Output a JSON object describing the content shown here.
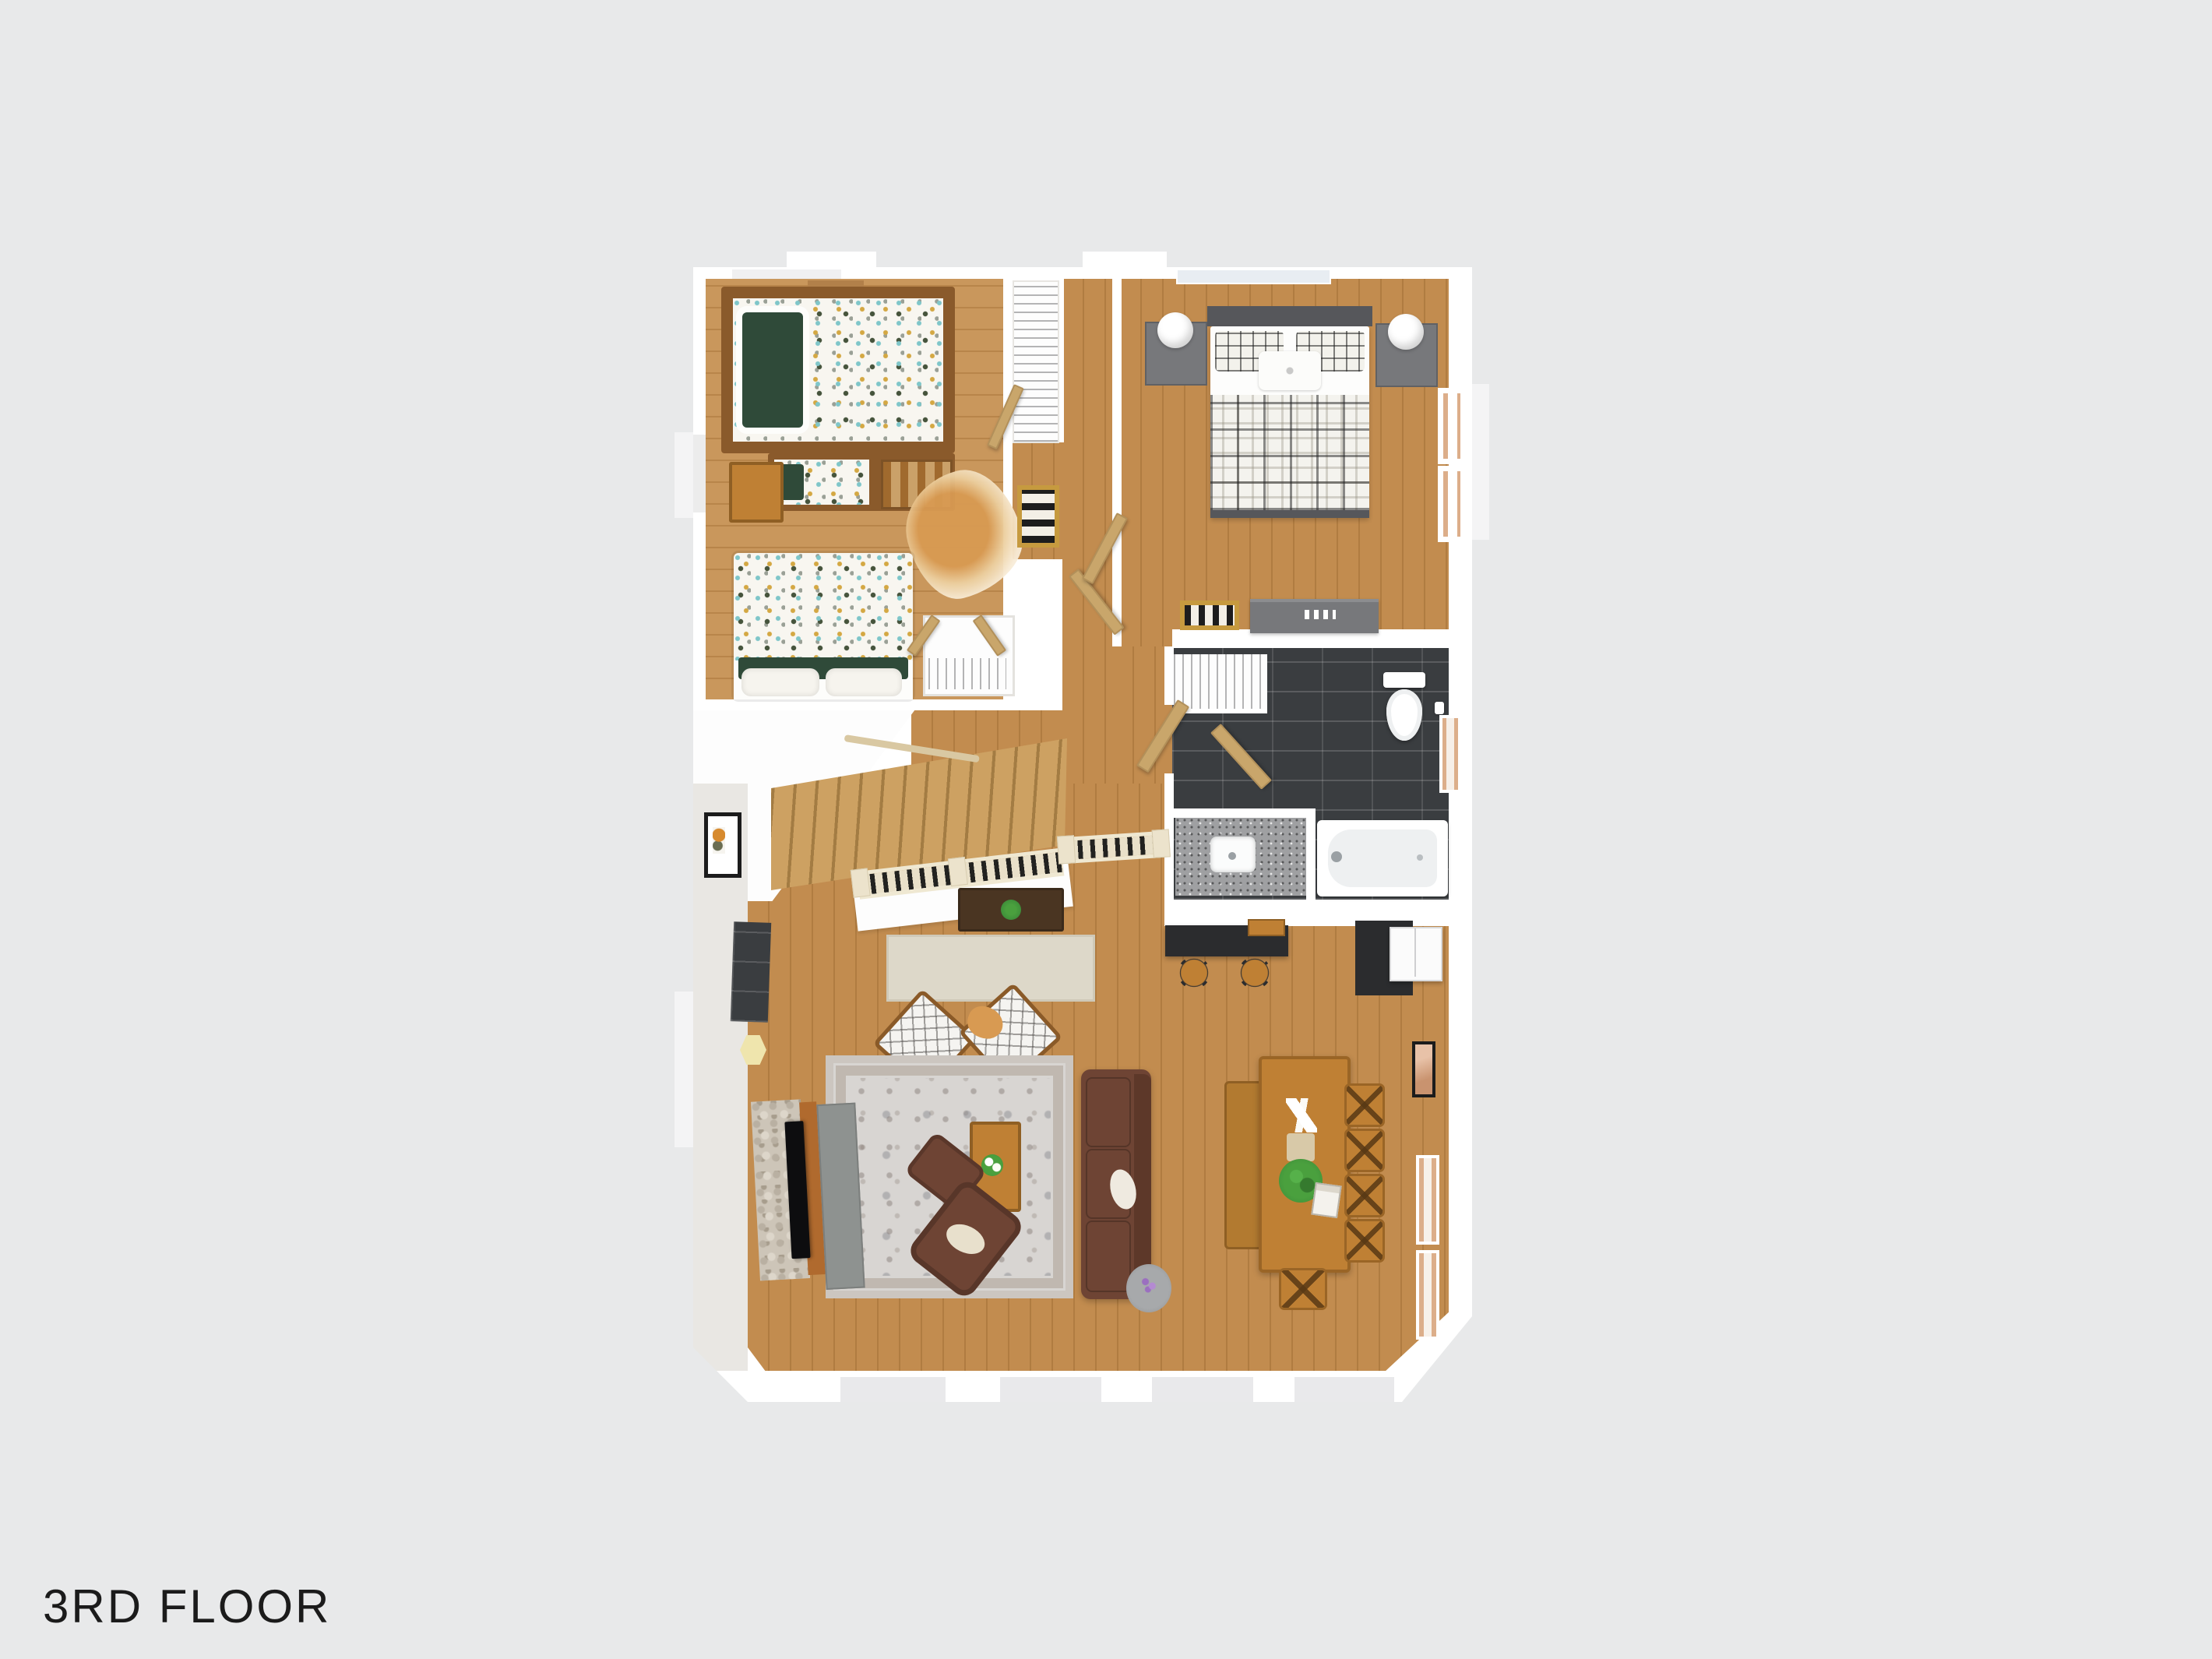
{
  "title": {
    "label": "3RD FLOOR"
  },
  "colors": {
    "bg": "#e8e9ea",
    "wall": "#ffffff",
    "wall-face": "#e9e7e3",
    "ink": "#1b1b1b",
    "wood": "#c28c4f",
    "wood-dark": "#b07c41",
    "wood-kids": "#c9975c",
    "wood-kids-dark": "#b8854a",
    "tile": "#3a3d40",
    "granite": "#9fa0a2",
    "stone": "#cdc5b8",
    "bunk-wood": "#8a5a2b",
    "oak": "#bf8034",
    "oak-dark": "#9a6526",
    "walnut": "#4a3522",
    "leather": "#6e4434",
    "leather-dark": "#5d3829",
    "rug": "#d8d5d2",
    "runner": "#ddd8c9",
    "furn-gray": "#77787b",
    "headboard": "#56575b",
    "counter-black": "#2b2c2e",
    "rail-cream": "#e9e0c9",
    "rail-dark": "#222220",
    "door-tan": "#c9a66b",
    "green-dark": "#2f4a39",
    "hide-tan": "#d89a52",
    "plant": "#3f8f3a",
    "lamp-white": "#ffffff",
    "glass": "#e8edf2",
    "accent-teal": "#7fc6c9",
    "accent-gold": "#d4a843",
    "accent-gray": "#9aa096",
    "purple": "#9b6fc0"
  }
}
